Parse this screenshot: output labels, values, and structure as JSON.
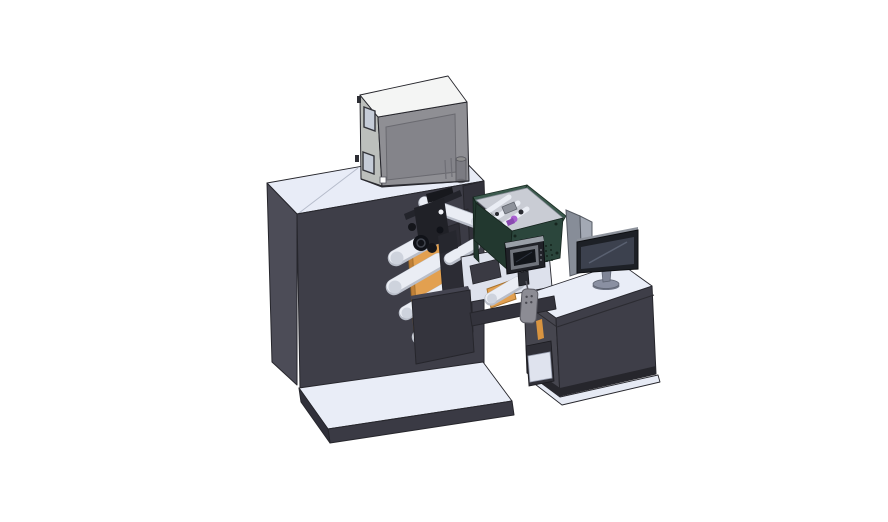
{
  "scene": {
    "type": "cad-3d-render",
    "description": "Isometric CAD rendering of a roll-fed label printing machine: large charcoal cabinet with a gray feeder box on top, web unwind unit with orange side plates and white guide rollers, a dark-green electronics enclosure with an HMI touch panel, and an operator desk with a monitor and divider screen, all standing on light base plates.",
    "background": "#ffffff"
  },
  "palette": {
    "bg": "#ffffff",
    "edge": "#26262c",
    "cabinet_top": "#e8ecf7",
    "cabinet_left": "#4c4c57",
    "cabinet_front": "#3e3e48",
    "cabinet_tower": "#32323b",
    "base_top": "#e9edf7",
    "base_front": "#3a3a44",
    "base_side": "#30303a",
    "box_top": "#f4f5f4",
    "box_front": "#8f8f94",
    "box_left": "#bcbfbc",
    "box_panel": "#84848a",
    "box_window": "#c5ccd8",
    "box_cylinder": "#7b7b82",
    "frame_rear": "#3b3b45",
    "frame_front": "#2c2c34",
    "orange": "#e2a050",
    "orange_dark": "#c08038",
    "roller_light": "#eaedf4",
    "roller_shade": "#b9bec9",
    "roller_cap": "#ced3dd",
    "gear_dark": "#101218",
    "gear_mid": "#23242b",
    "shelf_light": "#dde1ec",
    "green_front": "#2b463c",
    "green_side": "#22382f",
    "green_rim": "#3c5a4e",
    "green_interior": "#c9ccd4",
    "purple": "#a95fd0",
    "purple_dark": "#8a4ab0",
    "hmi_housing": "#202228",
    "hmi_top": "#9aa0a8",
    "hmi_bezel": "#70747c",
    "hmi_screen": "#12151a",
    "divider_left": "#878d98",
    "divider_right": "#a3a9b4",
    "desk_top": "#e9edf7",
    "desk_left": "#46464f",
    "desk_front": "#3e3e48",
    "desk_plinth": "#26262c",
    "monitor_bezel": "#1d2026",
    "monitor_screen": "#3c414e",
    "monitor_top": "#8e939c",
    "stand_gray": "#8a90a2",
    "stand_dark": "#6f7585",
    "beam": "#33333c",
    "remote": "#8c8c94",
    "white_detail": "#fdfdfd"
  }
}
